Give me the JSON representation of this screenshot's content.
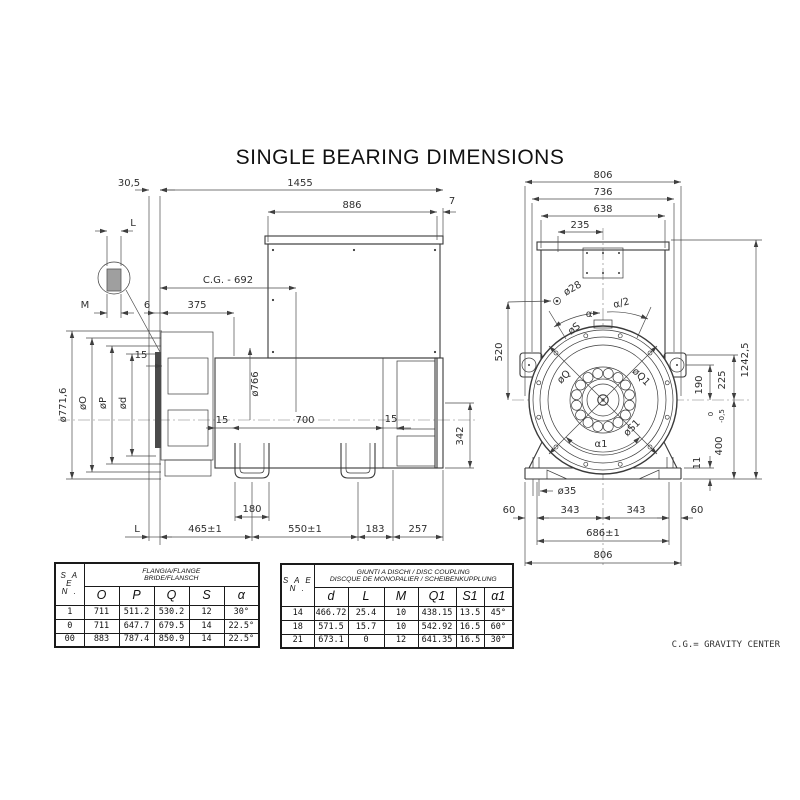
{
  "title": "SINGLE BEARING DIMENSIONS",
  "note": "C.G.= GRAVITY CENTER",
  "side": {
    "dim_30_5": "30,5",
    "dim_1455": "1455",
    "dim_886": "886",
    "dim_7": "7",
    "detail_L": "L",
    "detail_M": "M",
    "dim_6": "6",
    "dim_375": "375",
    "dim_cg": "C.G. - 692",
    "dia_766": "ø766",
    "dia_771_6": "ø771,6",
    "dia_O": "øO",
    "dia_P": "øP",
    "dia_d": "ød",
    "dim_15_disc": "15",
    "dim_15_left": "15",
    "dim_15_right": "15",
    "dim_700": "700",
    "dim_342": "342",
    "dim_180": "180",
    "dim_L": "L",
    "dim_465": "465±1",
    "dim_550": "550±1",
    "dim_183": "183",
    "dim_257": "257"
  },
  "front": {
    "dim_806_top": "806",
    "dim_736": "736",
    "dim_638": "638",
    "dim_235": "235",
    "dia_28": "ø28",
    "ang_alpha": "α",
    "ang_alpha_half": "α/2",
    "dia_S": "øS",
    "dim_520": "520",
    "dia_Q": "øQ",
    "dia_Q1": "øQ1",
    "dia_S1": "øS1",
    "ang_alpha1": "α1",
    "dim_190": "190",
    "dim_225": "225",
    "dim_400": "400",
    "tol_upper": "0",
    "tol_lower": "-0,5",
    "dim_1242_5": "1242,5",
    "dim_11": "11",
    "dia_35": "ø35",
    "dim_60_left": "60",
    "dim_343_left": "343",
    "dim_343_right": "343",
    "dim_60_right": "60",
    "dim_686": "686±1",
    "dim_806_bottom": "806"
  },
  "flange_table": {
    "sae_line1": "S A E",
    "sae_line2": "N .",
    "title_line1": "FLANGIA/FLANGE",
    "title_line2": "BRIDE/FLANSCH",
    "columns": [
      "O",
      "P",
      "Q",
      "S",
      "α"
    ],
    "rows": [
      [
        "1",
        "711",
        "511.2",
        "530.2",
        "12",
        "30°"
      ],
      [
        "0",
        "711",
        "647.7",
        "679.5",
        "14",
        "22.5°"
      ],
      [
        "00",
        "883",
        "787.4",
        "850.9",
        "14",
        "22.5°"
      ]
    ]
  },
  "coupling_table": {
    "sae_line1": "S A E",
    "sae_line2": "N .",
    "title_line1": "GIUNTI A DISCHI / DISC COUPLING",
    "title_line2": "DISCQUE DE MONOPALIER / SCHEIBENKUPPLUNG",
    "columns": [
      "d",
      "L",
      "M",
      "Q1",
      "S1",
      "α1"
    ],
    "rows": [
      [
        "14",
        "466.72",
        "25.4",
        "10",
        "438.15",
        "13.5",
        "45°"
      ],
      [
        "18",
        "571.5",
        "15.7",
        "10",
        "542.92",
        "16.5",
        "60°"
      ],
      [
        "21",
        "673.1",
        "0",
        "12",
        "641.35",
        "16.5",
        "30°"
      ]
    ]
  }
}
